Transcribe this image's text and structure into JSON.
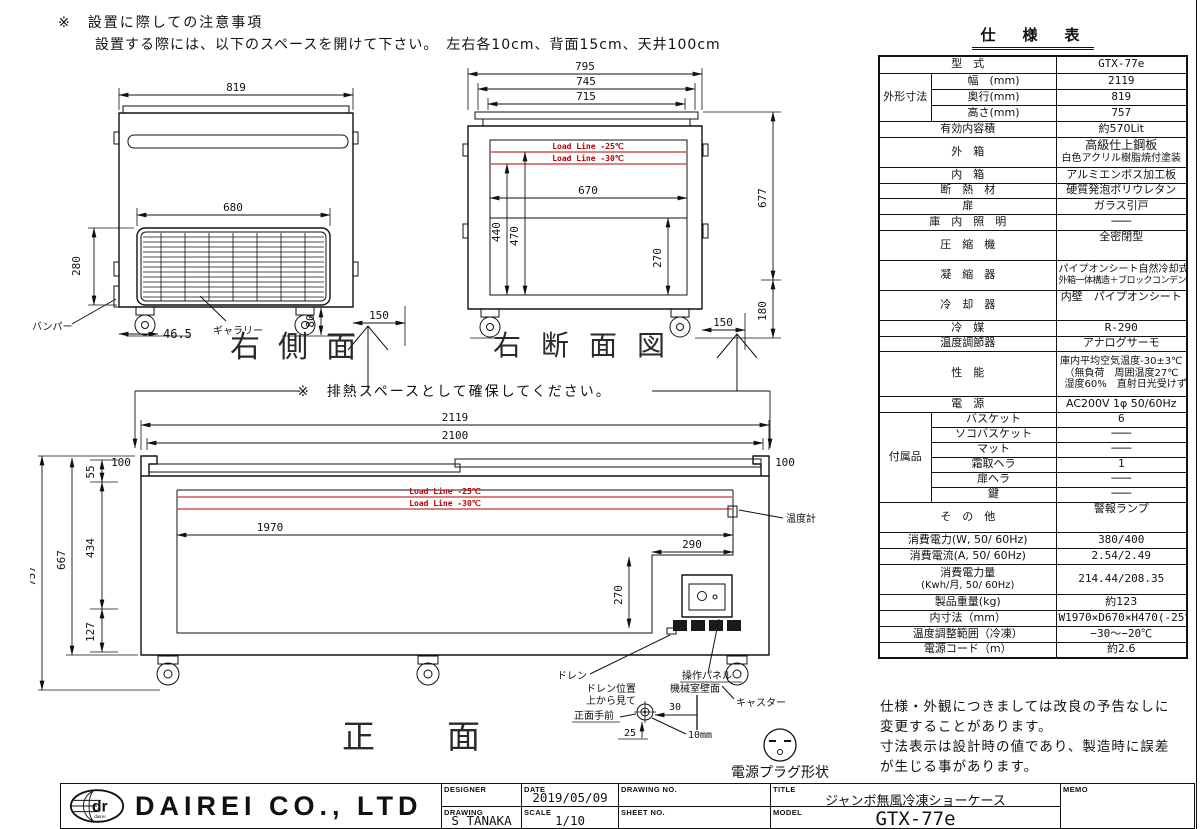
{
  "page": {
    "note_title": "※　設置に際しての注意事項",
    "note_body": "設置する際には、以下のスペースを開けて下さい。　左右各10cm、背面15cm、天井100cm",
    "heat_note": "※　排熱スペースとして確保してください。",
    "disclaimer1": "仕様・外観につきましては改良の予告なしに",
    "disclaimer2": "変更することがあります。",
    "disclaimer3": "寸法表示は設計時の値であり、製造時に誤差",
    "disclaimer4": "が生じる事があります。"
  },
  "side_view": {
    "title": "右側面",
    "d_width": "819",
    "d_grille_w": "680",
    "d_grille_h": "280",
    "d_bumper_off": "46.5",
    "d_caster_h": "80",
    "d_rear": "150",
    "label_bumper": "バンパー",
    "label_gallery": "ギャラリー"
  },
  "section_view": {
    "title": "右断面図",
    "d795": "795",
    "d745": "745",
    "d715": "715",
    "d670": "670",
    "d440": "440",
    "d470": "470",
    "d270": "270",
    "d677": "677",
    "d180": "180",
    "d150": "150",
    "load25": "Load Line -25℃",
    "load30": "Load Line -30℃"
  },
  "front_view": {
    "title": "正面",
    "d2119": "2119",
    "d2100": "2100",
    "d100": "100",
    "d55": "55",
    "d434": "434",
    "d667": "667",
    "d757": "757",
    "d127": "127",
    "d1970": "1970",
    "d290": "290",
    "d270": "270",
    "load25": "Load Line -25℃",
    "load30": "Load Line -30℃",
    "label_thermo": "温度計",
    "label_drain": "ドレン",
    "label_panel": "操作パネル",
    "label_caster": "キャスター",
    "drain_pos1": "ドレン位置",
    "drain_pos2": "上から見て",
    "drain_pos3": "正面手前",
    "label_wall": "機械室壁面",
    "d30": "30",
    "d25": "25",
    "d10mm": "10mm",
    "label_plug": "電源プラグ形状"
  },
  "spec": {
    "title": "仕　様　表",
    "model_label": "型　式",
    "model_value": "GTX-77e",
    "dims_label": "外形寸法",
    "width_label": "幅　(mm)",
    "width": "2119",
    "depth_label": "奥行(mm)",
    "depth": "819",
    "height_label": "高さ(mm)",
    "height": "757",
    "capacity_label": "有効内容積",
    "capacity": "約570Lit",
    "outer_label": "外　箱",
    "outer1": "高級仕上鋼板",
    "outer2": "白色アクリル樹脂焼付塗装",
    "inner_label": "内　箱",
    "inner": "アルミエンボス加工板",
    "insulation_label": "断　熱　材",
    "insulation": "硬質発泡ポリウレタン",
    "door_label": "扉",
    "door": "ガラス引戸",
    "light_label": "庫　内　照　明",
    "light": "───",
    "compressor_label": "圧　縮　機",
    "compressor": "全密閉型",
    "condenser_label": "凝　縮　器",
    "condenser1": "パイプオンシート自然冷却式",
    "condenser2": "外箱一体構造＋ブロックコンデンサー",
    "cooler_label": "冷　却　器",
    "cooler": "内壁　パイプオンシート",
    "refrigerant_label": "冷　媒",
    "refrigerant": "R-290",
    "thermostat_label": "温度調節器",
    "thermostat": "アナログサーモ",
    "performance_label": "性　能",
    "perf1": "庫内平均空気温度-30±3℃",
    "perf2": "（無負荷　周囲温度27℃",
    "perf3": "湿度60%　直射日光受けず）",
    "power_label": "電　源",
    "power": "AC200V 1φ 50/60Hz",
    "accessories_label": "付属品",
    "basket_label": "バスケット",
    "basket": "6",
    "bottom_basket_label": "ソコバスケット",
    "bottom_basket": "───",
    "mat_label": "マット",
    "mat": "───",
    "scraper_label": "霜取ヘラ",
    "scraper": "1",
    "door_scraper_label": "扉ヘラ",
    "door_scraper": "───",
    "key_label": "鍵",
    "key_value": "───",
    "other_label": "そ　の　他",
    "other": "警報ランプ",
    "watt_label": "消費電力(W, 50/ 60Hz)",
    "watt": "380/400",
    "amp_label": "消費電流(A, 50/ 60Hz)",
    "amp": "2.54/2.49",
    "kwh_label1": "消費電力量",
    "kwh_label2": "(Kwh/月, 50/ 60Hz)",
    "kwh": "214.44/208.35",
    "weight_label": "製品重量(kg)",
    "weight": "約123",
    "inner_dims_label": "内寸法（mm）",
    "inner_dims": "W1970×D670×H470(-25℃)",
    "temp_range_label": "温度調整範囲（冷凍）",
    "temp_range": "−30〜−20℃",
    "cord_label": "電源コード（m）",
    "cord": "約2.6"
  },
  "title_block": {
    "company": "DAIREI CO., LTD",
    "logo_dr": "dr",
    "logo_sub": "dairei",
    "designer_label": "DESIGNER",
    "date_label": "DATE",
    "date": "2019/05/09",
    "drawing_no_label": "DRAWING NO.",
    "title_label": "TITLE",
    "title": "ジャンボ無風冷凍ショーケース",
    "drawing_label": "DRAWING",
    "drawer": "S TANAKA",
    "scale_label": "SCALE",
    "scale": "1/10",
    "sheet_no_label": "SHEET NO.",
    "model_label": "MODEL",
    "model": "GTX-77e",
    "memo_label": "MEMO"
  }
}
